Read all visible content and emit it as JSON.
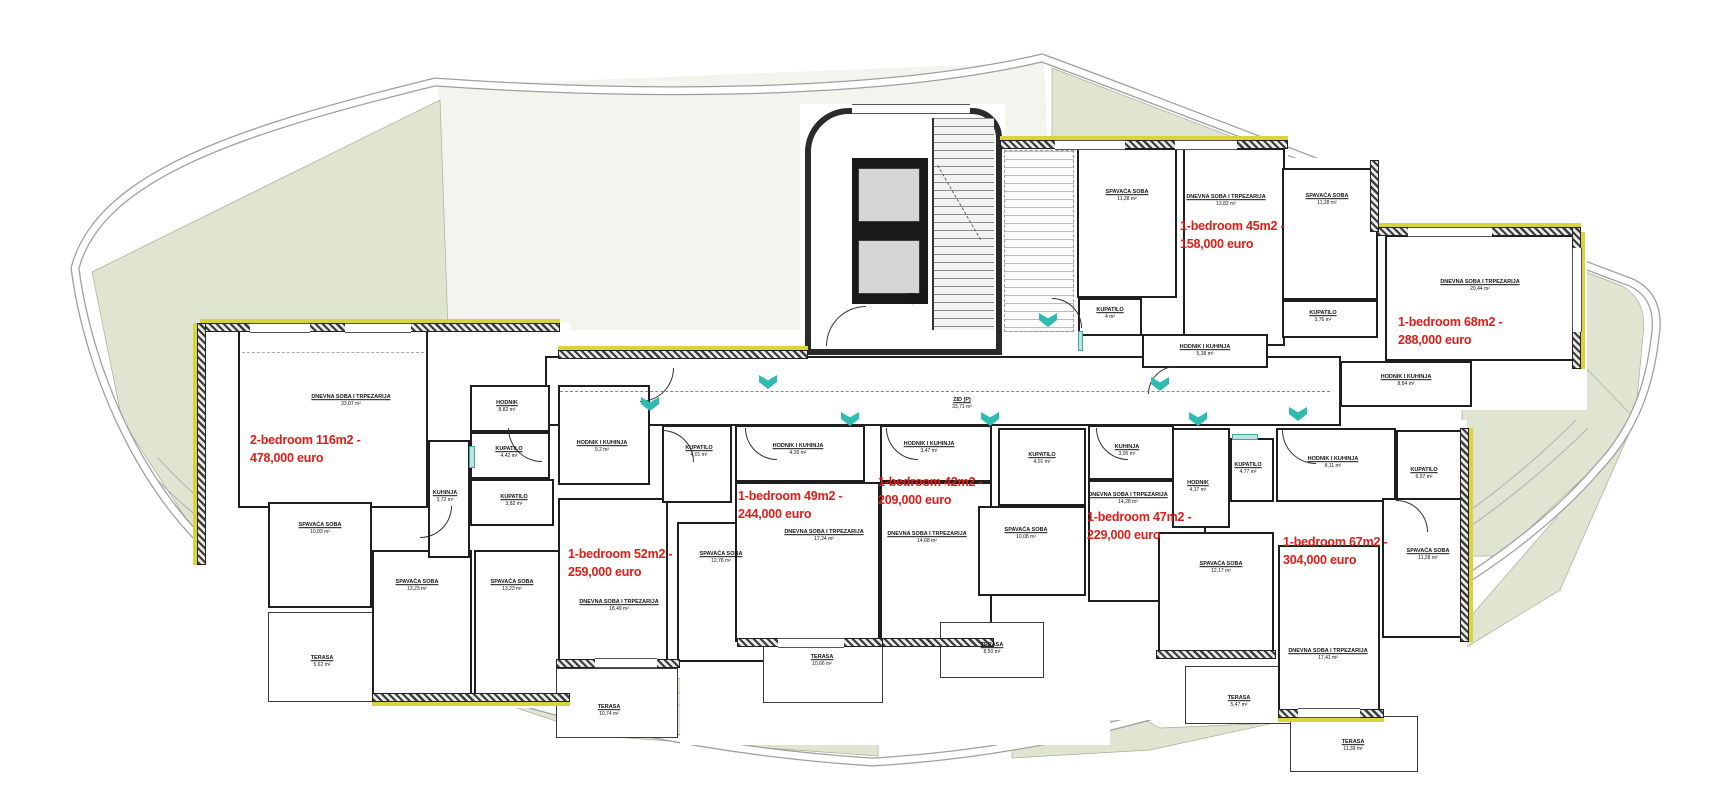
{
  "site": {
    "boundary_color": "#9e9e9e",
    "green_color": "#e0e5d2",
    "pale_color": "#f3f4ee",
    "wall_color": "#1f1f1f",
    "accent_yellow": "#d9d33c",
    "entry_marker_color": "#2fbcb0",
    "price_color": "#e31b17"
  },
  "apartments": [
    {
      "line1": "2-bedroom 116m2 -",
      "line2": "478,000 euro"
    },
    {
      "line1": "1-bedroom 52m2 -",
      "line2": "259,000 euro"
    },
    {
      "line1": "1-bedroom 49m2 -",
      "line2": "244,000 euro"
    },
    {
      "line1": "1-bedroom 42m2 -",
      "line2": "209,000 euro"
    },
    {
      "line1": "1-bedroom 47m2 -",
      "line2": "229,000 euro"
    },
    {
      "line1": "1-bedroom 67m2 -",
      "line2": "304,000 euro"
    },
    {
      "line1": "1-bedroom 45m2 -",
      "line2": "158,000 euro"
    },
    {
      "line1": "1-bedroom 68m2 -",
      "line2": "288,000 euro"
    }
  ],
  "rooms": [
    {
      "name": "DNEVNA SOBA I TRPEZARIJA",
      "area": "33,07 m²"
    },
    {
      "name": "SPAVAĆA SOBA",
      "area": "10,83 m²"
    },
    {
      "name": "TERASA",
      "area": "5,62 m²"
    },
    {
      "name": "SPAVAĆA SOBA",
      "area": "13,23 m²"
    },
    {
      "name": "SPAVAĆA SOBA",
      "area": "13,23 m²"
    },
    {
      "name": "KUHINJA",
      "area": "3,72 m²"
    },
    {
      "name": "HODNIK",
      "area": "8,82 m²"
    },
    {
      "name": "KUPATILO",
      "area": "4,42 m²"
    },
    {
      "name": "KUPATILO",
      "area": "3,82 m²"
    },
    {
      "name": "HODNIK I KUHINJA",
      "area": "9,2 m²"
    },
    {
      "name": "DNEVNA SOBA I TRPEZARIJA",
      "area": "18,49 m²"
    },
    {
      "name": "TERASA",
      "area": "10,74 m²"
    },
    {
      "name": "KUPATILO",
      "area": "4,01 m²"
    },
    {
      "name": "SPAVAĆA SOBA",
      "area": "12,78 m²"
    },
    {
      "name": "HODNIK I KUHINJA",
      "area": "4,26 m²"
    },
    {
      "name": "DNEVNA SOBA I TRPEZARIJA",
      "area": "17,24 m²"
    },
    {
      "name": "TERASA",
      "area": "10,66 m²"
    },
    {
      "name": "HODNIK I KUHINJA",
      "area": "3,47 m²"
    },
    {
      "name": "DNEVNA SOBA I TRPEZARIJA",
      "area": "14,68 m²"
    },
    {
      "name": "KUPATILO",
      "area": "4,01 m²"
    },
    {
      "name": "SPAVAĆA SOBA",
      "area": "10,08 m²"
    },
    {
      "name": "TERASA",
      "area": "8,50 m²"
    },
    {
      "name": "KUHINJA",
      "area": "3,05 m²"
    },
    {
      "name": "DNEVNA SOBA I TRPEZARIJA",
      "area": "14,28 m²"
    },
    {
      "name": "HODNIK",
      "area": "4,17 m²"
    },
    {
      "name": "KUPATILO",
      "area": "4,77 m²"
    },
    {
      "name": "SPAVAĆA SOBA",
      "area": "12,17 m²"
    },
    {
      "name": "TERASA",
      "area": "5,47 m²"
    },
    {
      "name": "HODNIK I KUHINJA",
      "area": "8,11 m²"
    },
    {
      "name": "KUPATILO",
      "area": "6,97 m²"
    },
    {
      "name": "SPAVAĆA SOBA",
      "area": "11,28 m²"
    },
    {
      "name": "DNEVNA SOBA I TRPEZARIJA",
      "area": "17,41 m²"
    },
    {
      "name": "TERASA",
      "area": "11,39 m²"
    },
    {
      "name": "SPAVAĆA SOBA",
      "area": "11,28 m²"
    },
    {
      "name": "DNEVNA SOBA I TRPEZARIJA",
      "area": "13,82 m²"
    },
    {
      "name": "KUPATILO",
      "area": "4 m²"
    },
    {
      "name": "HODNIK I KUHINJA",
      "area": "5,38 m²"
    },
    {
      "name": "SPAVAĆA SOBA",
      "area": "11,28 m²"
    },
    {
      "name": "KUPATILO",
      "area": "3,76 m²"
    },
    {
      "name": "DNEVNA SOBA I TRPEZARIJA",
      "area": "20,44 m²"
    },
    {
      "name": "HODNIK I KUHINJA",
      "area": "8,84 m²"
    },
    {
      "name": "ZID (P)",
      "area": "33,71 m²"
    },
    {
      "name": "ZID (P)",
      "area": "28,21 m²"
    }
  ]
}
